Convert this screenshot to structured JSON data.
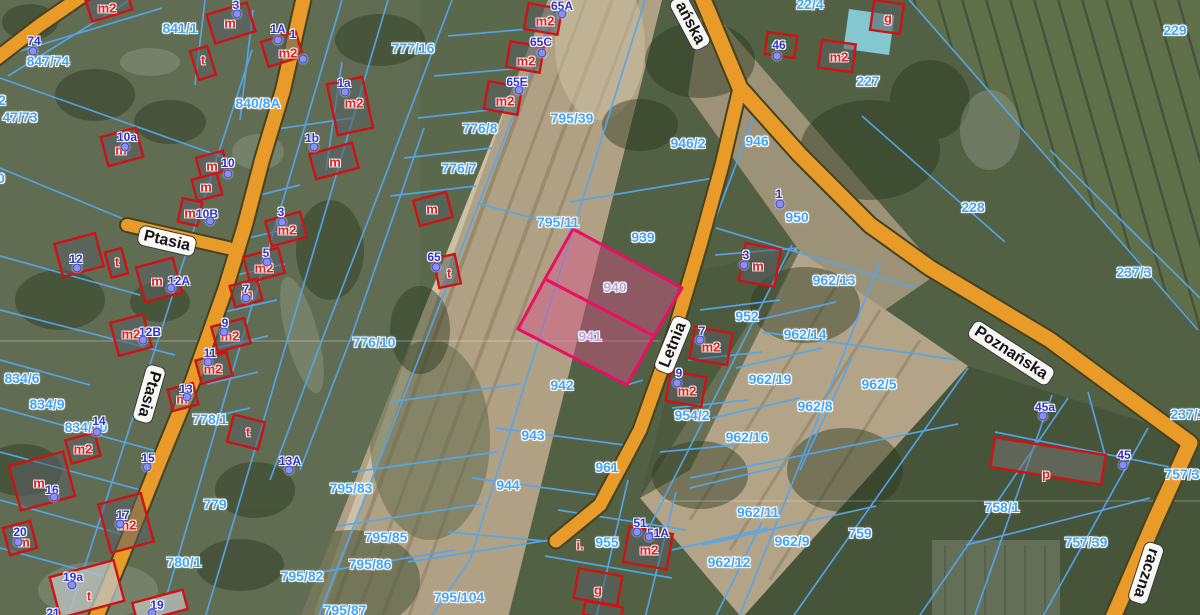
{
  "map": {
    "colors": {
      "parcel_line": "#55a6ec",
      "parcel_label": "#44a4f8",
      "highlight_stroke": "#ea0f63",
      "highlight_label": "#b7a2e2",
      "address_text": "#2a2fd0",
      "address_dot": "#8991ea",
      "building_outline": "#cf1212",
      "building_letter": "#e51c1c",
      "road_fill": "#e89b28"
    },
    "highlighted_parcels": [
      "940",
      "941"
    ]
  },
  "street_labels": [
    {
      "text": "Ptasia",
      "x": 167,
      "y": 241,
      "rot": 13
    },
    {
      "text": "Ptasia",
      "x": 149,
      "y": 394,
      "rot": 106
    },
    {
      "text": "Letnia",
      "x": 673,
      "y": 345,
      "rot": -68
    },
    {
      "text": "ańska",
      "x": 690,
      "y": 23,
      "rot": 62
    },
    {
      "text": "Poznańska",
      "x": 1011,
      "y": 353,
      "rot": 33
    },
    {
      "text": "raczna",
      "x": 1146,
      "y": 573,
      "rot": 108
    }
  ],
  "highlight_labels": [
    {
      "text": "940",
      "x": 615,
      "y": 287
    },
    {
      "text": "941",
      "x": 590,
      "y": 336
    }
  ],
  "parcel_labels": [
    {
      "text": "841/1",
      "x": 180,
      "y": 28
    },
    {
      "text": "847/74",
      "x": 48,
      "y": 61
    },
    {
      "text": "47/73",
      "x": 20,
      "y": 117
    },
    {
      "text": "2",
      "x": 2,
      "y": 100
    },
    {
      "text": "0",
      "x": 1,
      "y": 178
    },
    {
      "text": "840/8A",
      "x": 258,
      "y": 103
    },
    {
      "text": "777/16",
      "x": 413,
      "y": 48
    },
    {
      "text": "776/8",
      "x": 480,
      "y": 128
    },
    {
      "text": "776/7",
      "x": 459,
      "y": 168
    },
    {
      "text": "776/10",
      "x": 374,
      "y": 342
    },
    {
      "text": "795/39",
      "x": 572,
      "y": 118
    },
    {
      "text": "795/11",
      "x": 558,
      "y": 222
    },
    {
      "text": "939",
      "x": 643,
      "y": 237
    },
    {
      "text": "942",
      "x": 562,
      "y": 385
    },
    {
      "text": "943",
      "x": 533,
      "y": 435
    },
    {
      "text": "944",
      "x": 508,
      "y": 485
    },
    {
      "text": "961",
      "x": 607,
      "y": 467
    },
    {
      "text": "946/2",
      "x": 688,
      "y": 143
    },
    {
      "text": "946",
      "x": 757,
      "y": 141
    },
    {
      "text": "22/4",
      "x": 810,
      "y": 4
    },
    {
      "text": "227",
      "x": 868,
      "y": 81
    },
    {
      "text": "228",
      "x": 973,
      "y": 207
    },
    {
      "text": "229",
      "x": 1175,
      "y": 30
    },
    {
      "text": "237/3",
      "x": 1134,
      "y": 272
    },
    {
      "text": "237/1",
      "x": 1188,
      "y": 414
    },
    {
      "text": "950",
      "x": 797,
      "y": 217
    },
    {
      "text": "952",
      "x": 747,
      "y": 316
    },
    {
      "text": "962/13",
      "x": 834,
      "y": 280
    },
    {
      "text": "962/14",
      "x": 805,
      "y": 334
    },
    {
      "text": "962/19",
      "x": 770,
      "y": 379
    },
    {
      "text": "962/5",
      "x": 879,
      "y": 384
    },
    {
      "text": "962/8",
      "x": 815,
      "y": 406
    },
    {
      "text": "954/2",
      "x": 692,
      "y": 415
    },
    {
      "text": "962/16",
      "x": 747,
      "y": 437
    },
    {
      "text": "962/11",
      "x": 758,
      "y": 512
    },
    {
      "text": "962/9",
      "x": 792,
      "y": 541
    },
    {
      "text": "962/12",
      "x": 729,
      "y": 562
    },
    {
      "text": "759",
      "x": 860,
      "y": 533
    },
    {
      "text": "758/1",
      "x": 1002,
      "y": 507
    },
    {
      "text": "757/39",
      "x": 1086,
      "y": 542
    },
    {
      "text": "757/3",
      "x": 1182,
      "y": 474
    },
    {
      "text": "955",
      "x": 607,
      "y": 542
    },
    {
      "text": "795/83",
      "x": 351,
      "y": 488
    },
    {
      "text": "795/85",
      "x": 386,
      "y": 537
    },
    {
      "text": "795/86",
      "x": 370,
      "y": 564
    },
    {
      "text": "795/82",
      "x": 302,
      "y": 576
    },
    {
      "text": "795/87",
      "x": 345,
      "y": 610
    },
    {
      "text": "795/104",
      "x": 459,
      "y": 597
    },
    {
      "text": "780/1",
      "x": 184,
      "y": 562
    },
    {
      "text": "779",
      "x": 215,
      "y": 504
    },
    {
      "text": "778/1",
      "x": 210,
      "y": 419
    },
    {
      "text": "834/6",
      "x": 22,
      "y": 378
    },
    {
      "text": "834/9",
      "x": 47,
      "y": 404
    },
    {
      "text": "834/10",
      "x": 86,
      "y": 427
    }
  ],
  "address_points": [
    {
      "text": "74",
      "x": 34,
      "y": 41,
      "dx": 33,
      "dy": 51
    },
    {
      "text": "3",
      "x": 236,
      "y": 5,
      "dx": 237,
      "dy": 14
    },
    {
      "text": "1A",
      "x": 278,
      "y": 29,
      "dx": 278,
      "dy": 40
    },
    {
      "text": "1",
      "x": 293,
      "y": 34,
      "dx": 303,
      "dy": 59
    },
    {
      "text": "1a",
      "x": 344,
      "y": 83,
      "dx": 345,
      "dy": 92
    },
    {
      "text": "1b",
      "x": 312,
      "y": 138,
      "dx": 314,
      "dy": 147
    },
    {
      "text": "10a",
      "x": 127,
      "y": 137,
      "dx": 125,
      "dy": 147
    },
    {
      "text": "10",
      "x": 228,
      "y": 163,
      "dx": 228,
      "dy": 174
    },
    {
      "text": "10B",
      "x": 207,
      "y": 214,
      "dx": 210,
      "dy": 221
    },
    {
      "text": "12",
      "x": 76,
      "y": 259,
      "dx": 77,
      "dy": 268
    },
    {
      "text": "12A",
      "x": 179,
      "y": 281,
      "dx": 171,
      "dy": 288
    },
    {
      "text": "12B",
      "x": 150,
      "y": 332,
      "dx": 143,
      "dy": 340
    },
    {
      "text": "3",
      "x": 281,
      "y": 212,
      "dx": 282,
      "dy": 222
    },
    {
      "text": "5",
      "x": 266,
      "y": 253,
      "dx": 267,
      "dy": 262
    },
    {
      "text": "7",
      "x": 246,
      "y": 289,
      "dx": 246,
      "dy": 298
    },
    {
      "text": "9",
      "x": 225,
      "y": 323,
      "dx": 224,
      "dy": 332
    },
    {
      "text": "11",
      "x": 210,
      "y": 353,
      "dx": 208,
      "dy": 362
    },
    {
      "text": "13",
      "x": 186,
      "y": 389,
      "dx": 187,
      "dy": 397
    },
    {
      "text": "14",
      "x": 99,
      "y": 421,
      "dx": 97,
      "dy": 432
    },
    {
      "text": "15",
      "x": 148,
      "y": 458,
      "dx": 147,
      "dy": 467
    },
    {
      "text": "16",
      "x": 52,
      "y": 490,
      "dx": 54,
      "dy": 497
    },
    {
      "text": "17",
      "x": 123,
      "y": 515,
      "dx": 120,
      "dy": 524
    },
    {
      "text": "19a",
      "x": 73,
      "y": 577,
      "dx": 72,
      "dy": 585
    },
    {
      "text": "19",
      "x": 157,
      "y": 605,
      "dx": 152,
      "dy": 613
    },
    {
      "text": "20",
      "x": 20,
      "y": 532,
      "dx": 18,
      "dy": 542
    },
    {
      "text": "21",
      "x": 53,
      "y": 613,
      "dx": 50,
      "dy": 618
    },
    {
      "text": "13A",
      "x": 290,
      "y": 461,
      "dx": 289,
      "dy": 470
    },
    {
      "text": "65A",
      "x": 562,
      "y": 6,
      "dx": 562,
      "dy": 14
    },
    {
      "text": "65C",
      "x": 541,
      "y": 42,
      "dx": 542,
      "dy": 53
    },
    {
      "text": "65E",
      "x": 517,
      "y": 82,
      "dx": 519,
      "dy": 90
    },
    {
      "text": "65",
      "x": 434,
      "y": 257,
      "dx": 436,
      "dy": 267
    },
    {
      "text": "46",
      "x": 779,
      "y": 45,
      "dx": 777,
      "dy": 56
    },
    {
      "text": "1",
      "x": 779,
      "y": 194,
      "dx": 780,
      "dy": 204
    },
    {
      "text": "3",
      "x": 746,
      "y": 255,
      "dx": 744,
      "dy": 265
    },
    {
      "text": "7",
      "x": 702,
      "y": 331,
      "dx": 700,
      "dy": 340
    },
    {
      "text": "9",
      "x": 679,
      "y": 373,
      "dx": 677,
      "dy": 383
    },
    {
      "text": "51",
      "x": 640,
      "y": 523,
      "dx": 637,
      "dy": 532
    },
    {
      "text": "51A",
      "x": 658,
      "y": 533,
      "dx": 649,
      "dy": 537
    },
    {
      "text": "45a",
      "x": 1045,
      "y": 407,
      "dx": 1043,
      "dy": 416
    },
    {
      "text": "45",
      "x": 1124,
      "y": 455,
      "dx": 1123,
      "dy": 465
    }
  ],
  "building_labels": [
    {
      "text": "m2",
      "x": 107,
      "y": 8
    },
    {
      "text": "m",
      "x": 230,
      "y": 23
    },
    {
      "text": "t",
      "x": 203,
      "y": 60
    },
    {
      "text": "m2",
      "x": 288,
      "y": 53
    },
    {
      "text": "m2",
      "x": 354,
      "y": 103
    },
    {
      "text": "m",
      "x": 335,
      "y": 162
    },
    {
      "text": "m",
      "x": 206,
      "y": 187
    },
    {
      "text": "m",
      "x": 212,
      "y": 166
    },
    {
      "text": "m",
      "x": 121,
      "y": 150
    },
    {
      "text": "m",
      "x": 190,
      "y": 213
    },
    {
      "text": "t",
      "x": 117,
      "y": 262
    },
    {
      "text": "m",
      "x": 157,
      "y": 281
    },
    {
      "text": "m2",
      "x": 131,
      "y": 334
    },
    {
      "text": "m2",
      "x": 287,
      "y": 230
    },
    {
      "text": "m2",
      "x": 264,
      "y": 268
    },
    {
      "text": "m",
      "x": 247,
      "y": 294
    },
    {
      "text": "m2",
      "x": 230,
      "y": 336
    },
    {
      "text": "m2",
      "x": 213,
      "y": 369
    },
    {
      "text": "m",
      "x": 182,
      "y": 399
    },
    {
      "text": "m2",
      "x": 83,
      "y": 449
    },
    {
      "text": "m",
      "x": 39,
      "y": 483
    },
    {
      "text": "m",
      "x": 24,
      "y": 542
    },
    {
      "text": "m2",
      "x": 127,
      "y": 525
    },
    {
      "text": "t",
      "x": 89,
      "y": 596
    },
    {
      "text": "t",
      "x": 248,
      "y": 432
    },
    {
      "text": "m2",
      "x": 545,
      "y": 21
    },
    {
      "text": "m2",
      "x": 526,
      "y": 61
    },
    {
      "text": "m2",
      "x": 505,
      "y": 101
    },
    {
      "text": "t",
      "x": 449,
      "y": 273
    },
    {
      "text": "m",
      "x": 432,
      "y": 209
    },
    {
      "text": "g",
      "x": 888,
      "y": 18
    },
    {
      "text": "m2",
      "x": 839,
      "y": 57
    },
    {
      "text": "m",
      "x": 758,
      "y": 266
    },
    {
      "text": "m2",
      "x": 711,
      "y": 347
    },
    {
      "text": "m2",
      "x": 687,
      "y": 391
    },
    {
      "text": "m2",
      "x": 649,
      "y": 550
    },
    {
      "text": "i.",
      "x": 580,
      "y": 545
    },
    {
      "text": "g",
      "x": 598,
      "y": 590
    },
    {
      "text": "p",
      "x": 1046,
      "y": 474
    }
  ]
}
